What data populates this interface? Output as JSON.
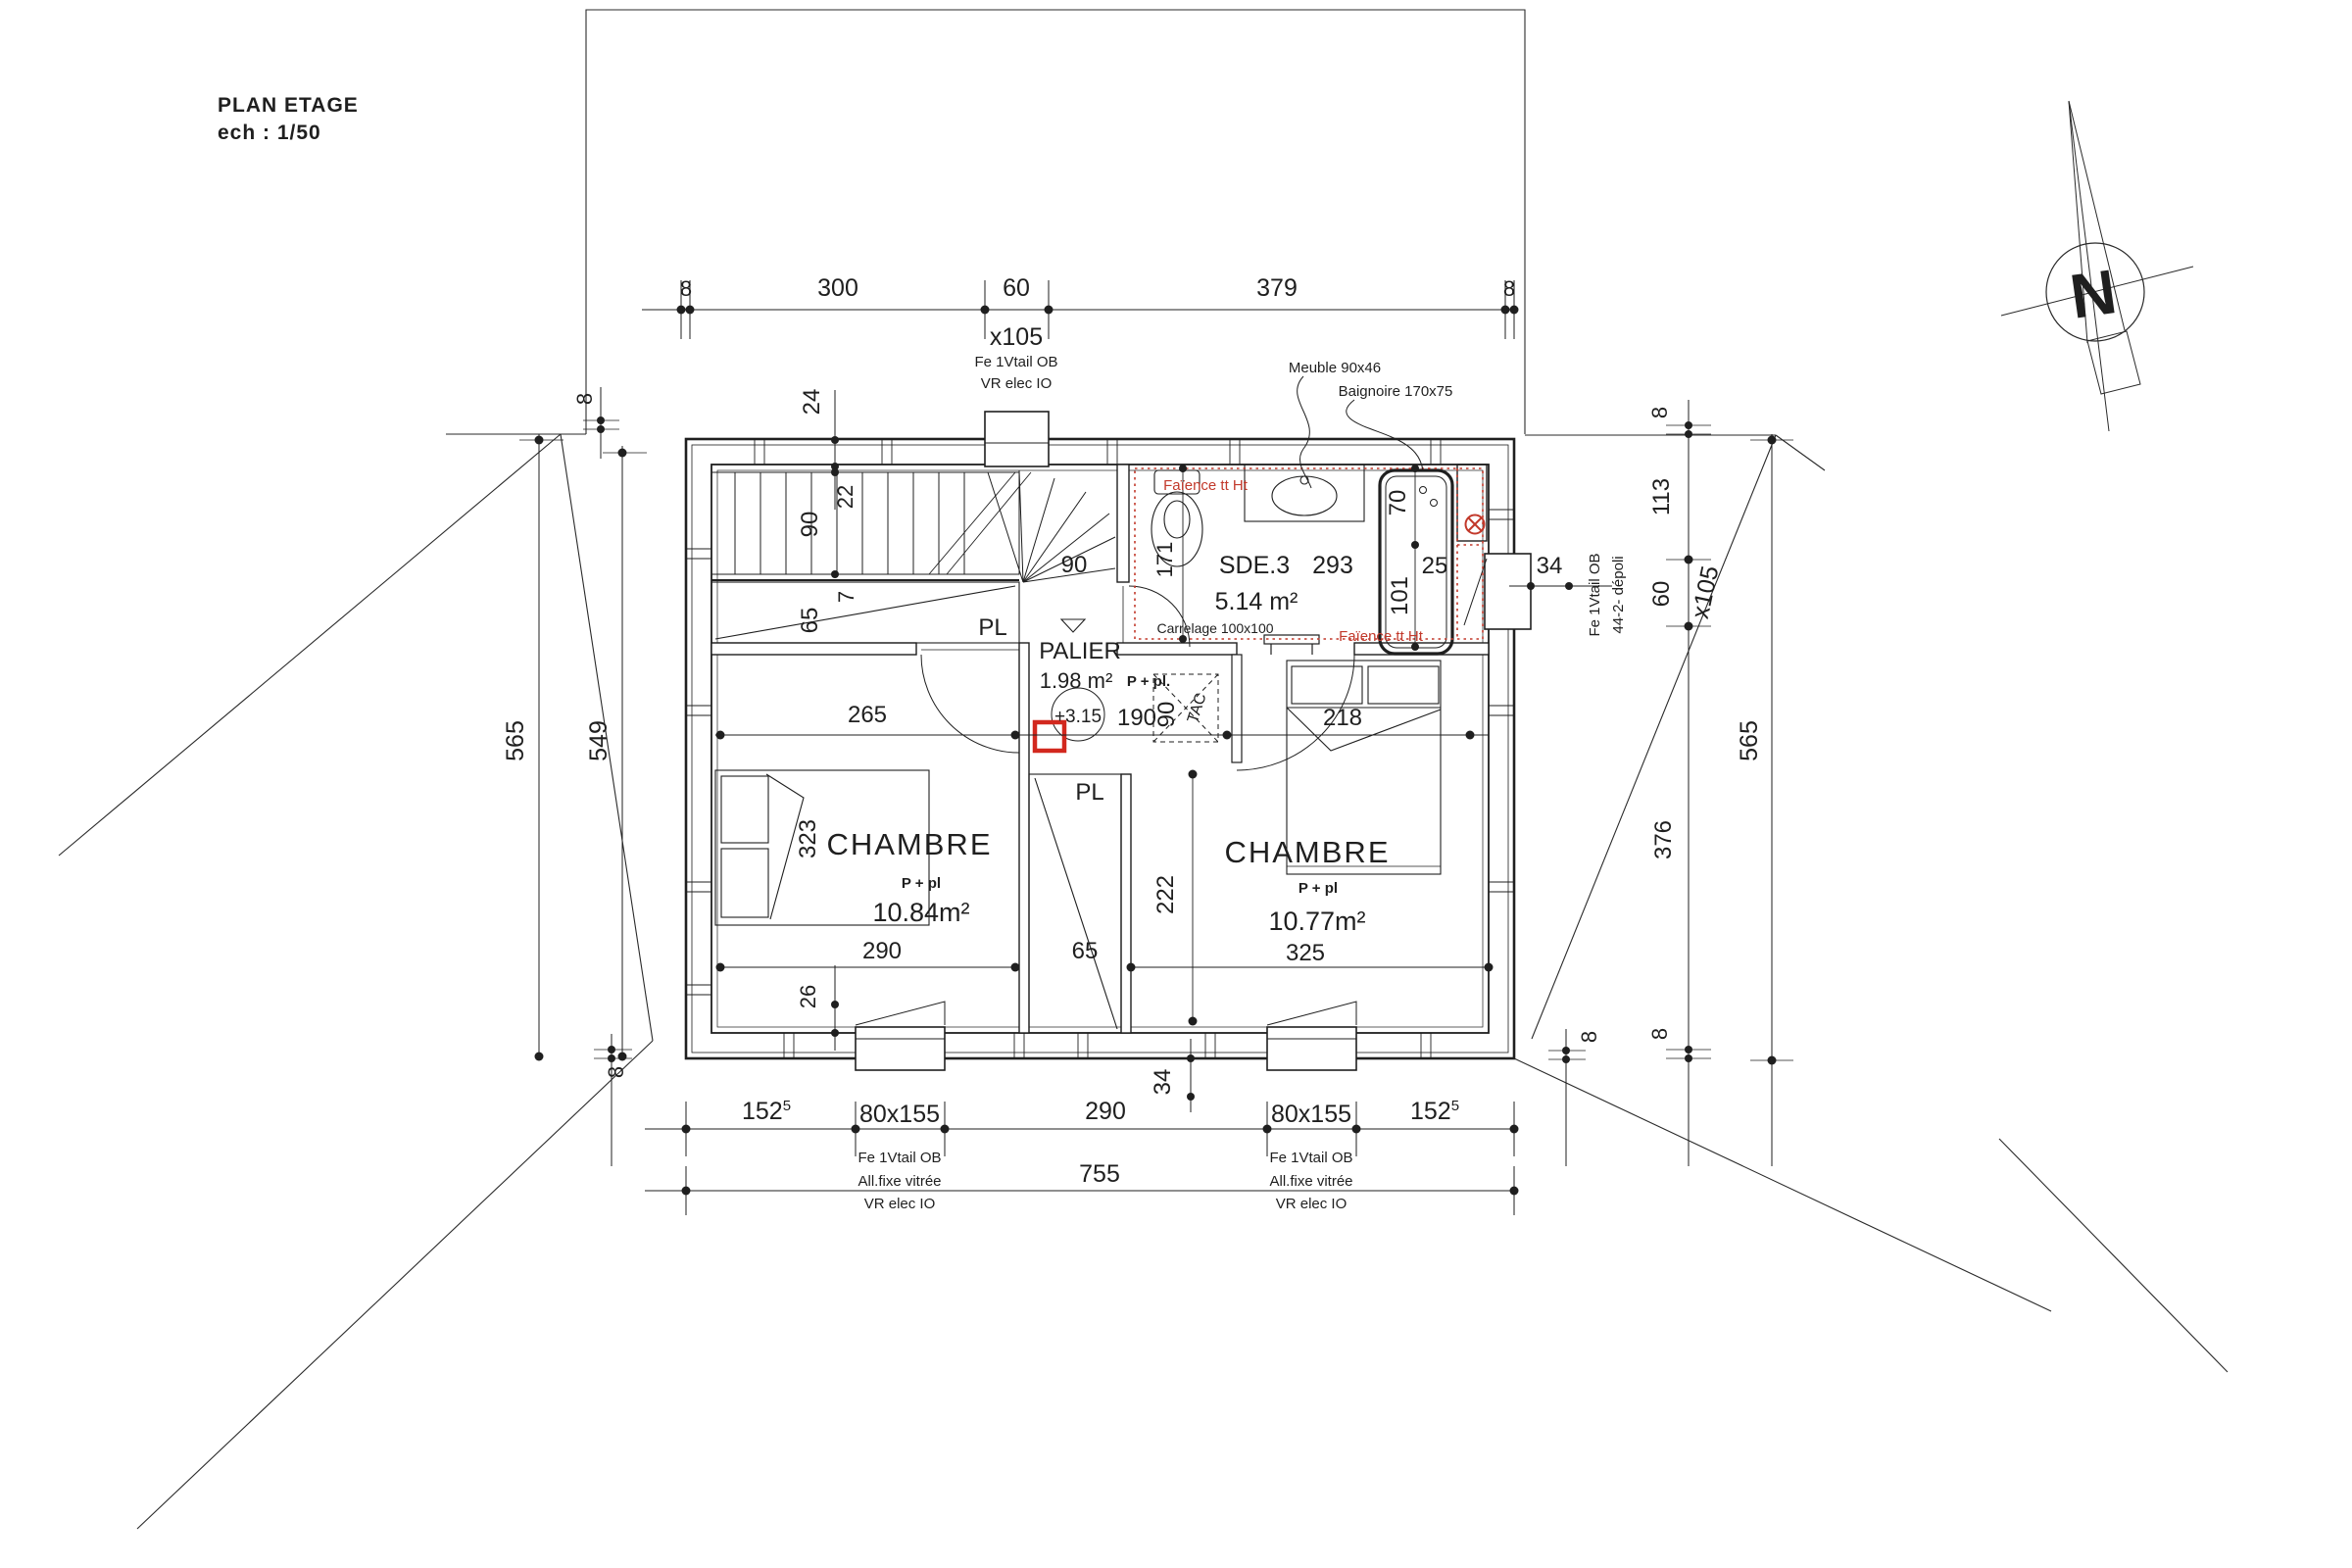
{
  "colors": {
    "ink": "#1f1f1f",
    "red": "#c2392b"
  },
  "title_block": {
    "title": "PLAN  ETAGE",
    "scale": "ech : 1/50"
  },
  "north": {
    "label": "N"
  },
  "dim_top": {
    "d8l": "8",
    "d300": "300",
    "d60": "60",
    "d379": "379",
    "d8r": "8"
  },
  "window_top": {
    "size": "x105",
    "note1": "Fe 1Vtail OB",
    "note2": "VR elec IO"
  },
  "callouts": {
    "meuble": "Meuble 90x46",
    "baignoire": "Baignoire 170x75"
  },
  "left_dims": {
    "d8top": "8",
    "d24": "24",
    "d565": "565",
    "d549": "549",
    "d8bottom": "8"
  },
  "right_dims": {
    "d8top": "8",
    "d113": "113",
    "d60": "60",
    "size": "x105",
    "note1": "Fe 1Vtail OB",
    "note2": "44-2- dépoli",
    "d565": "565",
    "d376": "376",
    "d8bottom": "8"
  },
  "bathroom": {
    "name": "SDE.3",
    "d293": "293",
    "area": "5.14 m²",
    "floor": "Carrelage 100x100",
    "faience_top": "Faïence tt Ht",
    "faience_bottom": "Faïence tt Ht",
    "d171": "171",
    "d70": "70",
    "d101": "101",
    "d25": "25",
    "d34": "34"
  },
  "stairs": {
    "d90": "90",
    "d22": "22",
    "d65": "65",
    "d7": "7",
    "d90_winder": "90",
    "pl": "PL"
  },
  "palier": {
    "name": "PALIER",
    "area": "1.98 m²",
    "ppl": "P + pl.",
    "level": "+3.15",
    "d190": "190",
    "d90": "90",
    "tac": "TAC",
    "d265": "265"
  },
  "bedroom_left": {
    "name": "CHAMBRE",
    "ppl": "P + pl",
    "area": "10.84m²",
    "d323": "323",
    "d290": "290",
    "d26": "26"
  },
  "bedroom_right": {
    "name": "CHAMBRE",
    "ppl": "P + pl",
    "area": "10.77m²",
    "d218": "218",
    "d222": "222",
    "d325": "325"
  },
  "closet_center": {
    "pl": "PL",
    "d65": "65"
  },
  "bottom_dims": {
    "d152l": "152",
    "sup_l": "5",
    "win_l": "80x155",
    "d290": "290",
    "win_r": "80x155",
    "d152r": "152",
    "sup_r": "5",
    "total": "755",
    "d34": "34",
    "d8corner": "8",
    "notes": [
      "Fe 1Vtail OB",
      "All.fixe vitrée",
      "VR elec IO"
    ]
  }
}
